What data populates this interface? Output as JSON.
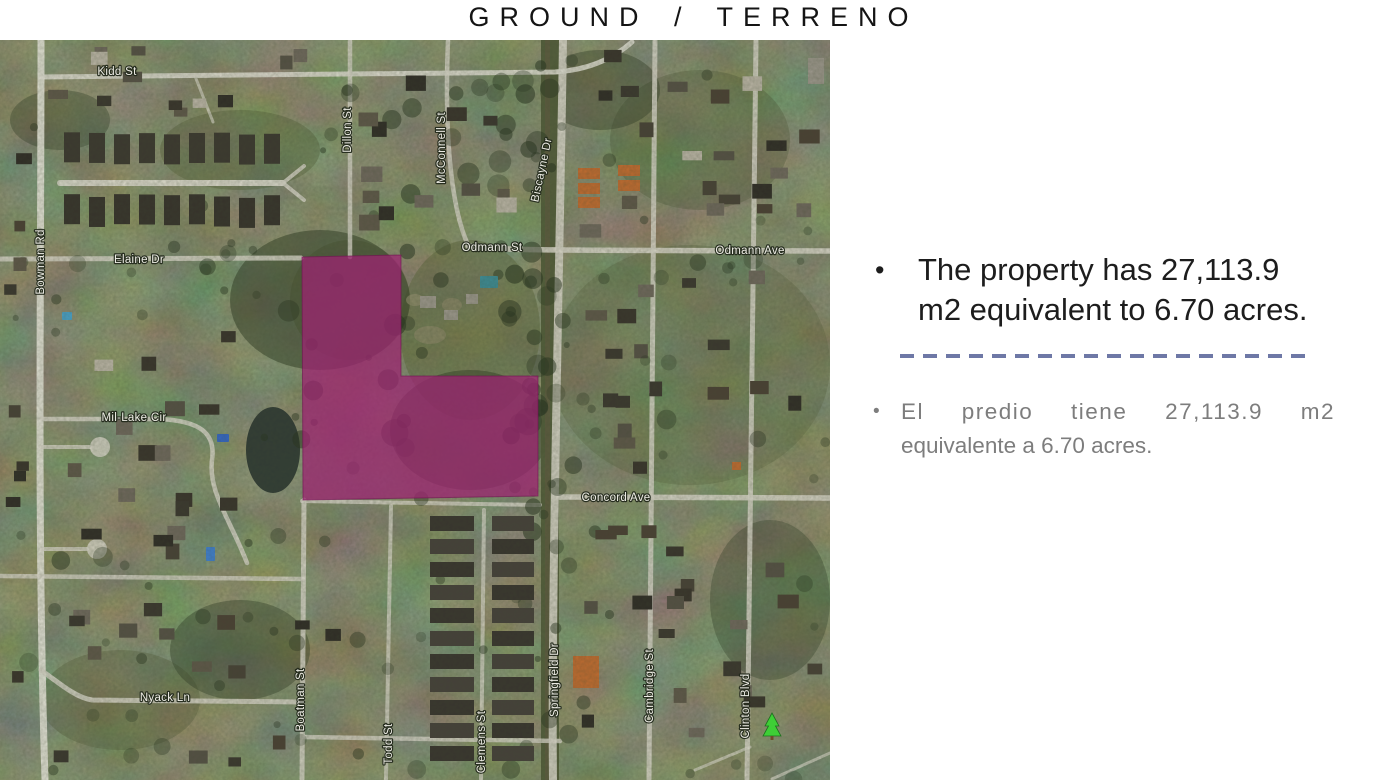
{
  "slide": {
    "title": "GROUND / TERRENO",
    "bullets": {
      "en": {
        "marker": "•",
        "lines": [
          "The property has 27,113.9",
          "m2 equivalent to 6.70 acres."
        ]
      },
      "es": {
        "marker": "•",
        "lines": [
          "El predio tiene 27,113.9 m2",
          "equivalente a 6.70 acres."
        ]
      }
    },
    "divider_color": "#6e78a6"
  },
  "map": {
    "streets": [
      {
        "name": "Kidd St",
        "x": 117,
        "y": 72,
        "rot": 0
      },
      {
        "name": "Dillon St",
        "x": 348,
        "y": 130,
        "rot": -90
      },
      {
        "name": "McConnell St",
        "x": 442,
        "y": 148,
        "rot": -90
      },
      {
        "name": "Biscayne Dr",
        "x": 542,
        "y": 170,
        "rot": -78
      },
      {
        "name": "Odmann St",
        "x": 492,
        "y": 248,
        "rot": 0
      },
      {
        "name": "Odmann Ave",
        "x": 750,
        "y": 251,
        "rot": 0
      },
      {
        "name": "Elaine Dr",
        "x": 139,
        "y": 260,
        "rot": 0
      },
      {
        "name": "Bowman Rd",
        "x": 41,
        "y": 262,
        "rot": -90
      },
      {
        "name": "Mil-Lake Cir",
        "x": 134,
        "y": 418,
        "rot": 0
      },
      {
        "name": "Concord Ave",
        "x": 616,
        "y": 498,
        "rot": 0
      },
      {
        "name": "Springfield Dr",
        "x": 555,
        "y": 680,
        "rot": -90
      },
      {
        "name": "Cambridge St",
        "x": 650,
        "y": 686,
        "rot": -90
      },
      {
        "name": "Clinton Blvd",
        "x": 746,
        "y": 706,
        "rot": -90
      },
      {
        "name": "Boatman St",
        "x": 301,
        "y": 700,
        "rot": -90
      },
      {
        "name": "Todd St",
        "x": 389,
        "y": 744,
        "rot": -90
      },
      {
        "name": "Clemens St",
        "x": 482,
        "y": 742,
        "rot": -90
      },
      {
        "name": "Nyack Ln",
        "x": 165,
        "y": 698,
        "rot": 0
      }
    ],
    "property_overlay": {
      "color": "#9c2371",
      "opacity": 0.74,
      "points": [
        [
          302,
          257
        ],
        [
          401,
          255
        ],
        [
          401,
          376
        ],
        [
          538,
          376
        ],
        [
          538,
          496
        ],
        [
          303,
          500
        ]
      ]
    },
    "park_marker": {
      "x": 772,
      "y": 724
    }
  }
}
